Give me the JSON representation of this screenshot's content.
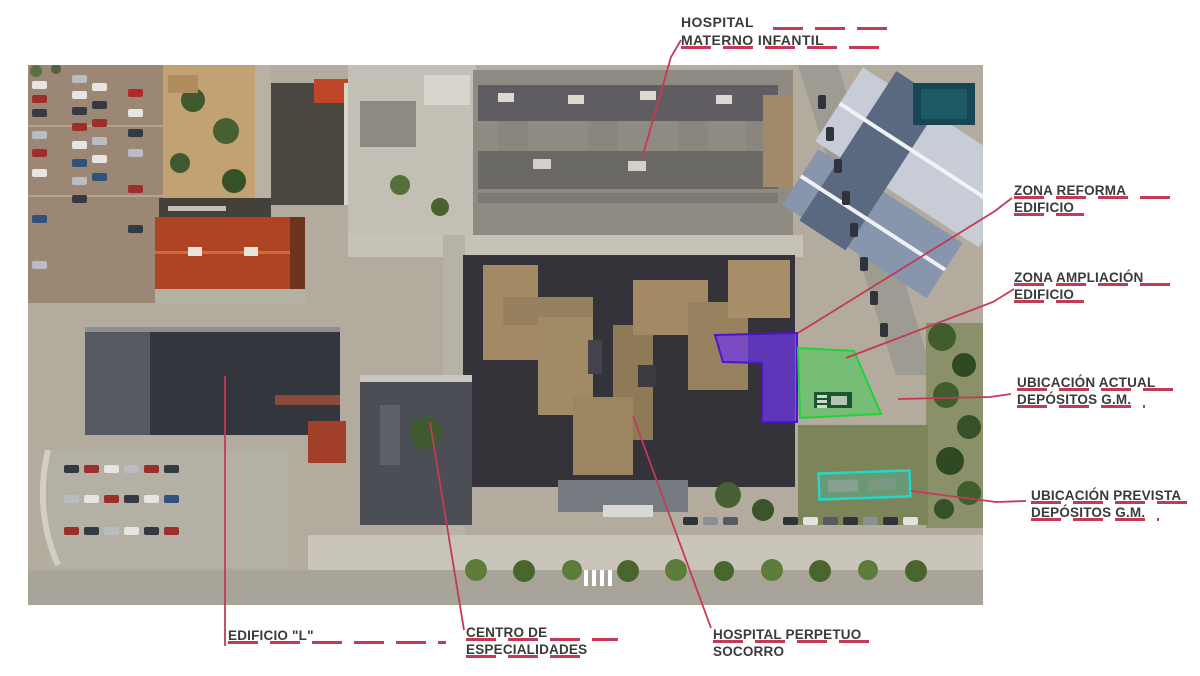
{
  "annotations": {
    "hospital_materno_infantil": {
      "line1": "HOSPITAL",
      "line2": "MATERNO INFANTIL"
    },
    "zona_reforma": {
      "line1": "ZONA REFORMA",
      "line2": "EDIFICIO"
    },
    "zona_ampliacion": {
      "line1": "ZONA AMPLIACIÓN",
      "line2": "EDIFICIO"
    },
    "ubicacion_actual": {
      "line1": "UBICACIÓN ACTUAL",
      "line2": "DEPÓSITOS G.M."
    },
    "ubicacion_prevista": {
      "line1": "UBICACIÓN PREVISTA",
      "line2": "DEPÓSITOS G.M."
    },
    "edificio_l": {
      "line1": "EDIFICIO \"L\""
    },
    "centro_especialidades": {
      "line1": "CENTRO DE",
      "line2": "ESPECIALIDADES"
    },
    "hospital_perpetuo_socorro": {
      "line1": "HOSPITAL PERPETUO",
      "line2": "SOCORRO"
    }
  },
  "colors": {
    "annotation_line": "#c43a56",
    "label_text": "#3a3a3a",
    "zone_reforma": "#7038e8",
    "zone_actual_depositos": "#3ad04e",
    "zone_prevista_depositos": "#35d8cc"
  }
}
